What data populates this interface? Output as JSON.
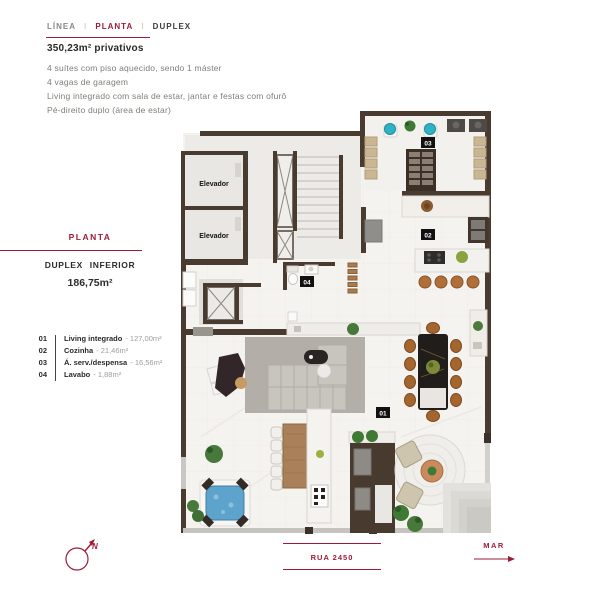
{
  "accent_color": "#9e1b38",
  "wall_color": "#4a3b31",
  "header": {
    "brand": "LÍNEA",
    "separator": "I",
    "active": "PLANTA",
    "tail": "DUPLEX"
  },
  "specs": {
    "title": "350,23m² privativos",
    "features": [
      "4 suítes com piso aquecido, sendo 1 máster",
      "4 vagas de garagem",
      "Living integrado com sala de estar, jantar e festas com ofurô",
      "Pé-direito duplo (área de estar)"
    ]
  },
  "plan_info": {
    "label": "PLANTA",
    "name": "DUPLEX INFERIOR",
    "area": "186,75m²"
  },
  "legend": {
    "items": [
      {
        "num": "01",
        "label": "Living integrado",
        "value": "- 127,00m²"
      },
      {
        "num": "02",
        "label": "Cozinha",
        "value": "- 21,46m²"
      },
      {
        "num": "03",
        "label": "Á. serv./despensa",
        "value": "- 16,56m²"
      },
      {
        "num": "04",
        "label": "Lavabo",
        "value": "- 1,88m²"
      }
    ]
  },
  "floorplan": {
    "elevator_label": "Elevador",
    "tags": {
      "living": "01",
      "cozinha": "02",
      "servico": "03",
      "lavabo": "04"
    }
  },
  "footer": {
    "compass_n": "N",
    "street": "RUA 2450",
    "sea": "MAR"
  }
}
